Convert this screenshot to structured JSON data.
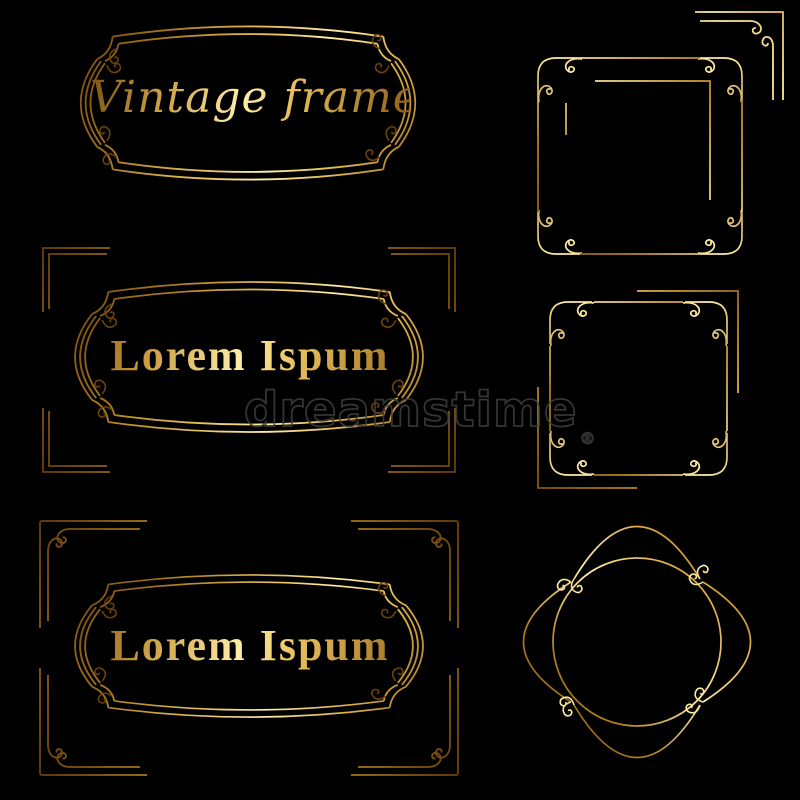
{
  "canvas": {
    "background_color": "#000000",
    "gold_light": "#ffeea6",
    "gold_mid": "#d9a441",
    "gold_dark": "#6a3f0a",
    "watermark_color": "#3f3f3f"
  },
  "labels": {
    "vintage_title": "Vintage frames",
    "lorem_middle": "Lorem Ispum",
    "lorem_bottom": "Lorem Ispum"
  },
  "watermark": {
    "text": "dreamstime",
    "registered_mark": "®"
  },
  "ornaments": [
    "oval-plaque-frame-top-left",
    "oval-plaque-frame-middle-left",
    "oval-plaque-frame-bottom-left",
    "plain-corner-brackets-middle-left",
    "scroll-corner-brackets-bottom-left",
    "square-scroll-frame-top-right",
    "corner-flourish-top-right",
    "square-scroll-frame-middle-right",
    "round-scroll-frame-bottom-right"
  ]
}
